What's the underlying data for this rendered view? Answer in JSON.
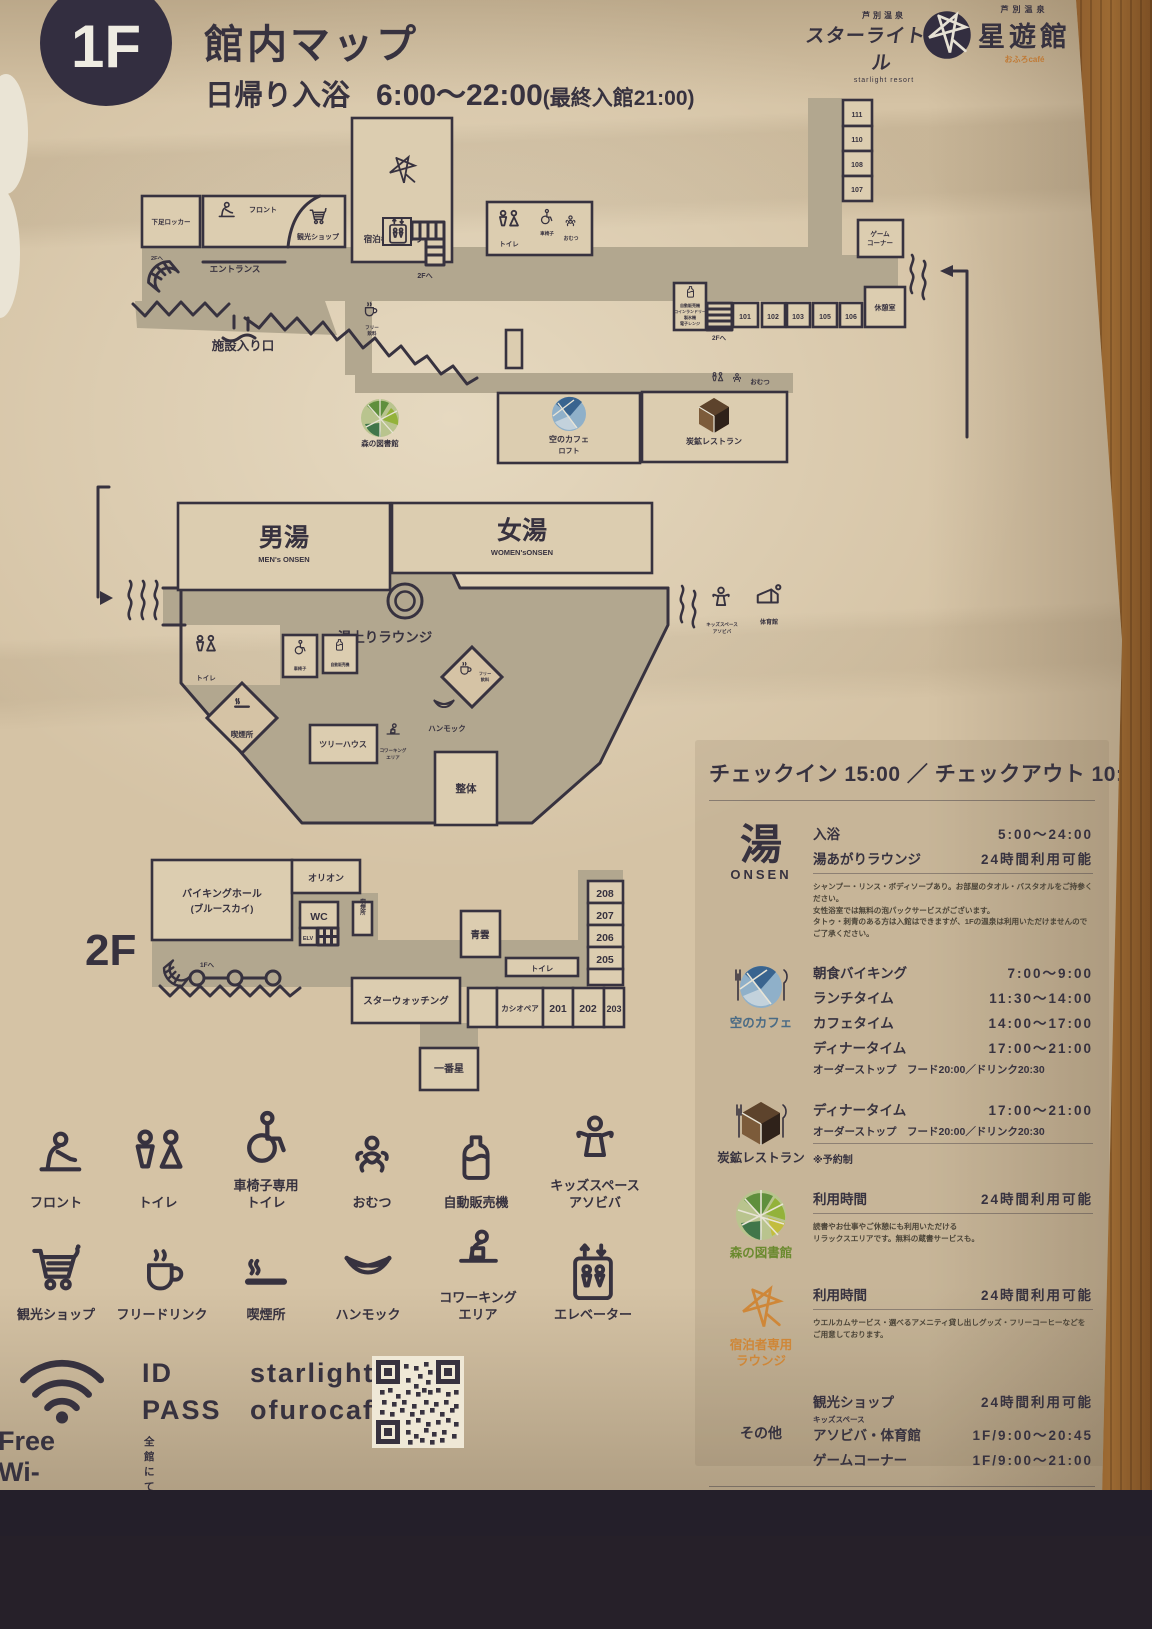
{
  "header": {
    "floor_badge": "1F",
    "title": "館内マップ",
    "daytrip_label": "日帰り入浴",
    "daytrip_hours": "6:00〜22:00",
    "daytrip_note": "(最終入館21:00)",
    "hotel_logo_top": "芦別温泉",
    "hotel_logo": "スターライトホテル",
    "hotel_logo_sub": "starlight resort",
    "seiyukan_logo_top": "芦別温泉",
    "seiyukan_logo": "星遊館",
    "seiyukan_logo_sub": "おふろcafé"
  },
  "f1": {
    "guest_lounge": "宿泊者専用ラウンジ",
    "shoe_locker": "下足ロッカー",
    "front": "フロント",
    "shop": "観光ショップ",
    "entrance": "エントランス",
    "facility_entrance": "施設入り口",
    "to_2f_a": "2Fへ",
    "to_2f_b": "2Fへ",
    "to_2f_c": "2Fへ",
    "toilet": "トイレ",
    "wheelchair": "車椅子",
    "diaper": "おむつ",
    "rooms_col": [
      "111",
      "110",
      "108",
      "107"
    ],
    "game_corner": [
      "ゲーム",
      "コーナー"
    ],
    "rest_room": "休憩室",
    "rooms_row": [
      "101",
      "102",
      "103",
      "105",
      "106"
    ],
    "vending_lines": [
      "自動販売機",
      "コインランドリー",
      "製氷機",
      "電子レンジ"
    ],
    "free_drink": [
      "フリー",
      "飲料"
    ],
    "library": "森の図書館",
    "sky_cafe": "空のカフェ",
    "sky_cafe_sub": "ロフト",
    "coal_restaurant": "炭鉱レストラン",
    "diaper2": "おむつ"
  },
  "onsen": {
    "mens": "男湯",
    "mens_en": "MEN's ONSEN",
    "womens": "女湯",
    "womens_en": "WOMEN'sONSEN",
    "lounge": "湯上りラウンジ",
    "toilet": "トイレ",
    "wheelchair": "車椅子",
    "vending": "自動販売機",
    "smoking": "喫煙所",
    "treehouse": "ツリーハウス",
    "hammock": "ハンモック",
    "coworking": [
      "コワーキング",
      "エリア"
    ],
    "free_drink": [
      "フリー",
      "飲料"
    ],
    "seitai": "整体",
    "kids": [
      "キッズスペース",
      "アソビバ"
    ],
    "gym": "体育館"
  },
  "f2": {
    "badge": "2F",
    "viking": [
      "バイキングホール",
      "(ブルースカイ)"
    ],
    "orion": "オリオン",
    "wc": "WC",
    "elv": "ELV",
    "smoking": "喫煙所",
    "seiun": "青雲",
    "toilet": "トイレ",
    "to_1f": "1Fへ",
    "star_watching": "スターウォッチング",
    "cassiopeia": "カシオペア",
    "rooms_col": [
      "208",
      "207",
      "206",
      "205"
    ],
    "rooms_row": [
      "201",
      "202",
      "203"
    ],
    "ichibanboshi": "一番星"
  },
  "legend": {
    "items": [
      {
        "line1": "フロント",
        "line2": ""
      },
      {
        "line1": "トイレ",
        "line2": ""
      },
      {
        "line1": "車椅子専用",
        "line2": "トイレ"
      },
      {
        "line1": "おむつ",
        "line2": ""
      },
      {
        "line1": "自動販売機",
        "line2": ""
      },
      {
        "line1": "キッズスペース",
        "line2": "アソビバ"
      },
      {
        "line1": "観光ショップ",
        "line2": ""
      },
      {
        "line1": "フリードリンク",
        "line2": ""
      },
      {
        "line1": "喫煙所",
        "line2": ""
      },
      {
        "line1": "ハンモック",
        "line2": ""
      },
      {
        "line1": "コワーキング",
        "line2": "エリア"
      },
      {
        "line1": "エレベーター",
        "line2": ""
      }
    ]
  },
  "panel": {
    "checkinout": "チェックイン 15:00 ／ チェックアウト 10:00",
    "onsen": {
      "kanji": "湯",
      "en": "ONSEN",
      "rows": [
        {
          "l": "入浴",
          "t": "5:00〜24:00"
        },
        {
          "l": "湯あがりラウンジ",
          "t": "24時間利用可能"
        }
      ],
      "notes": [
        "シャンプー・リンス・ボディソープあり。お部屋のタオル・バスタオルをご持参ください。",
        "女性浴室では無料の泡パックサービスがございます。",
        "タトゥ・刺青のある方は入館はできますが、1Fの温泉は利用いただけませんのでご了承ください。"
      ]
    },
    "cafe": {
      "name": "空のカフェ",
      "rows": [
        {
          "l": "朝食バイキング",
          "t": "7:00〜9:00"
        },
        {
          "l": "ランチタイム",
          "t": "11:30〜14:00"
        },
        {
          "l": "カフェタイム",
          "t": "14:00〜17:00"
        },
        {
          "l": "ディナータイム",
          "t": "17:00〜21:00"
        }
      ],
      "order_stop": "オーダーストップ　フード20:00／ドリンク20:30"
    },
    "restaurant": {
      "name": "炭鉱レストラン",
      "rows": [
        {
          "l": "ディナータイム",
          "t": "17:00〜21:00"
        }
      ],
      "order_stop": "オーダーストップ　フード20:00／ドリンク20:30",
      "reserve": "※予約制"
    },
    "library": {
      "name": "森の図書館",
      "rows": [
        {
          "l": "利用時間",
          "t": "24時間利用可能"
        }
      ],
      "notes": [
        "読書やお仕事やご休憩にも利用いただける",
        "リラックスエリアです。無料の蔵書サービスも。"
      ]
    },
    "lounge": {
      "name1": "宿泊者専用",
      "name2": "ラウンジ",
      "rows": [
        {
          "l": "利用時間",
          "t": "24時間利用可能"
        }
      ],
      "notes": [
        "ウエルカムサービス・選べるアメニティ貸し出しグッズ・フリーコーヒーなどを",
        "ご用意しております。"
      ]
    },
    "others": {
      "name": "その他",
      "row1": {
        "l": "観光ショップ",
        "t": "24時間利用可能"
      },
      "row2": {
        "sup": "キッズスペース",
        "l": "アソビバ・体育館",
        "t": "1F/9:00〜20:45"
      },
      "row3": {
        "l": "ゲームコーナー",
        "t": "1F/9:00〜21:00"
      }
    },
    "star_watching": "スターウォッチング（星空鑑賞会） 20:00〜〈予約制〉",
    "star_watching_note": "★フロントまでお申込みください。〈先着順〉★"
  },
  "wifi": {
    "title": "Free Wi-Fi",
    "id_label": "ID",
    "id_value": "starlight",
    "pass_label": "PASS",
    "pass_value": "ofurocafe",
    "note": "全館にてご利用いただけます。"
  }
}
